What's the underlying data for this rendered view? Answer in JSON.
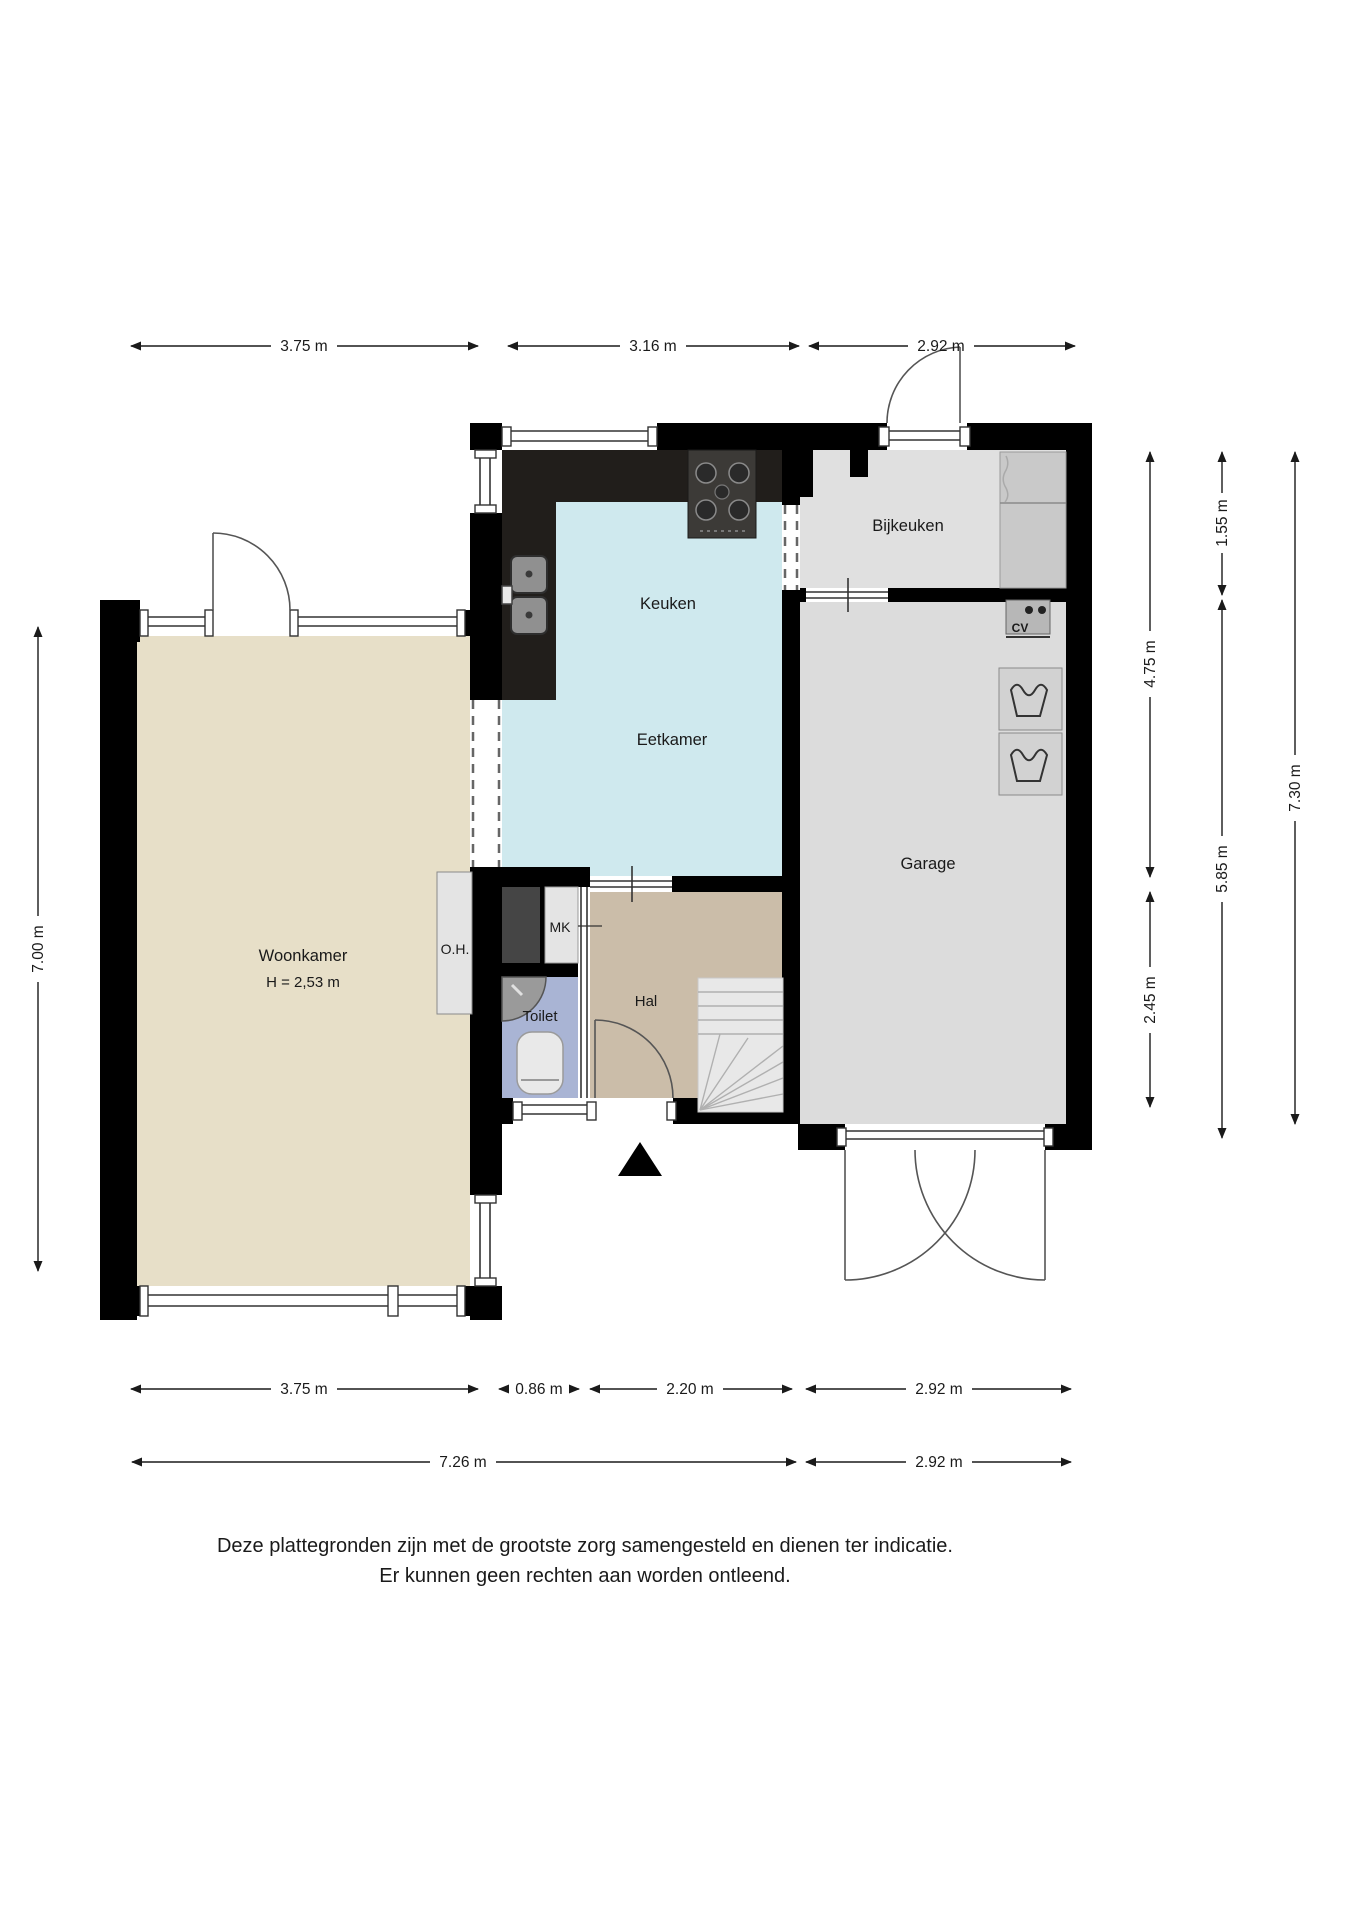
{
  "plan": {
    "rooms": {
      "woonkamer": {
        "label": "Woonkamer",
        "height_label": "H = 2,53 m"
      },
      "keuken": {
        "label": "Keuken"
      },
      "eetkamer": {
        "label": "Eetkamer"
      },
      "bijkeuken": {
        "label": "Bijkeuken"
      },
      "garage": {
        "label": "Garage"
      },
      "hal": {
        "label": "Hal"
      },
      "toilet": {
        "label": "Toilet"
      },
      "oh": {
        "label": "O.H."
      },
      "mk": {
        "label": "MK"
      },
      "cv": {
        "label": "CV"
      }
    },
    "dimensions": {
      "top": [
        {
          "label": "3.75 m"
        },
        {
          "label": "3.16 m"
        },
        {
          "label": "2.92 m"
        }
      ],
      "left": [
        {
          "label": "7.00 m"
        }
      ],
      "right_inner": [
        {
          "label": "4.75 m"
        },
        {
          "label": "2.45 m"
        }
      ],
      "right_middle": [
        {
          "label": "1.55 m"
        },
        {
          "label": "5.85 m"
        }
      ],
      "right_outer": [
        {
          "label": "7.30 m"
        }
      ],
      "bottom_row1": [
        {
          "label": "3.75 m"
        },
        {
          "label": "0.86 m"
        },
        {
          "label": "2.20 m"
        },
        {
          "label": "2.92 m"
        }
      ],
      "bottom_row2": [
        {
          "label": "7.26 m"
        },
        {
          "label": "2.92 m"
        }
      ]
    },
    "disclaimer": {
      "line1": "Deze plattegronden zijn met de grootste zorg samengesteld en dienen ter indicatie.",
      "line2": "Er kunnen geen rechten aan worden ontleend."
    },
    "colors": {
      "wall": "#000000",
      "woonkamer": "#e7dfc8",
      "keuken_floor": "#cfe9ee",
      "hal": "#cbbda9",
      "toilet": "#a9b4d4",
      "garage": "#dcdcdc",
      "bijkeuken": "#e0e0e0",
      "counter_dark": "#211e1b",
      "stove": "#3c3a37",
      "counter_light": "#c9c9c9",
      "unit_light": "#e4e4e4",
      "kast_dark": "#454545",
      "stairs": "#e8e8e8",
      "sink": "#909090"
    }
  }
}
